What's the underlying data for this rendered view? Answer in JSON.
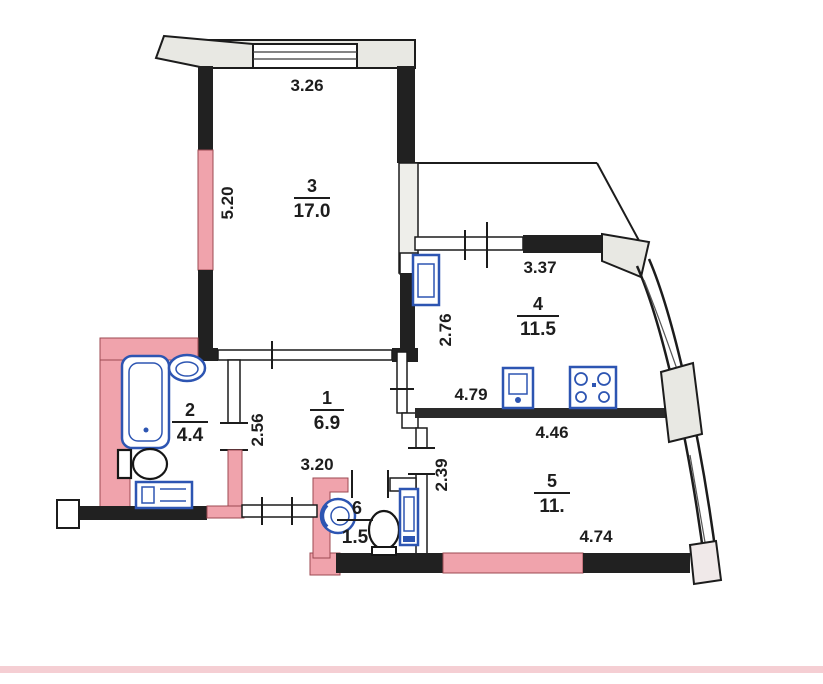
{
  "plan": {
    "type": "apartment-floor-plan",
    "rooms": [
      {
        "key": "room-3",
        "number": "3",
        "area": "17.0"
      },
      {
        "key": "room-4",
        "number": "4",
        "area": "11.5"
      },
      {
        "key": "room-1",
        "number": "1",
        "area": "6.9"
      },
      {
        "key": "room-2",
        "number": "2",
        "area": "4.4"
      },
      {
        "key": "room-5",
        "number": "5",
        "area": "11."
      },
      {
        "key": "room-6",
        "number": "6",
        "area": "1.5"
      }
    ],
    "dimensions": {
      "room3_top": "3.26",
      "room3_left": "5.20",
      "room4_top": "3.37",
      "room4_left": "2.76",
      "room4_counter": "4.79",
      "room1_left": "2.56",
      "room1_bottom": "3.20",
      "room5_top": "4.46",
      "room5_left": "2.39",
      "room5_bottom": "4.74"
    },
    "fixtures": [
      "bathtub",
      "washbasin",
      "toilet",
      "washing-machine",
      "fridge",
      "kitchen-sink",
      "stove",
      "wc-sink",
      "wc-toilet",
      "water-heater"
    ],
    "colors": {
      "wall_black": "#212121",
      "wall_pink": "#f0a3ac",
      "wall_window": "#e8e8e3",
      "fixture_blue": "#2d55b2",
      "outline": "#1c1c1c",
      "stripe_pink": "#f4c9ce"
    }
  }
}
